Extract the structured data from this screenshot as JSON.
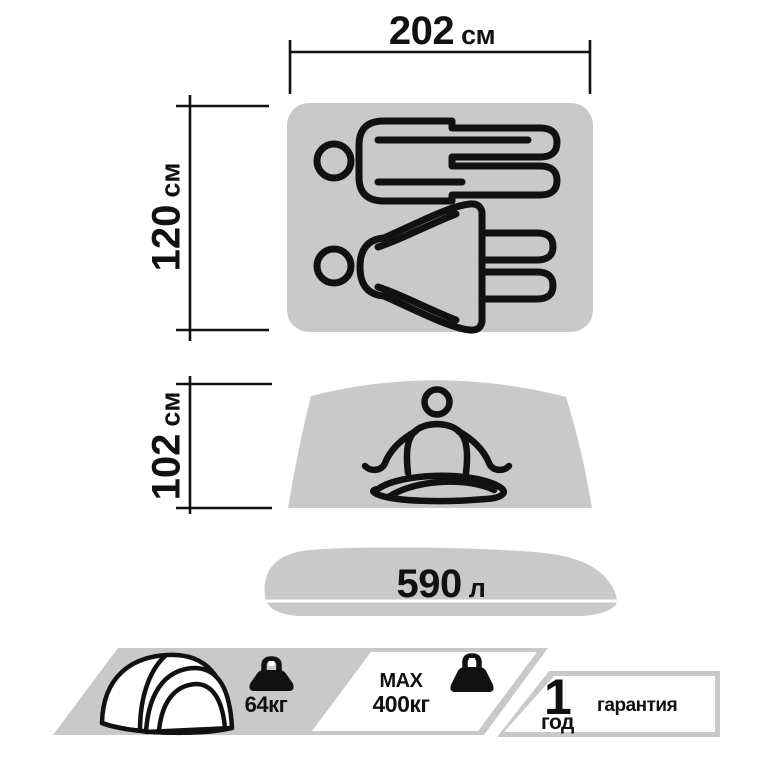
{
  "colors": {
    "shape": "#c9c9c9",
    "ink": "#111111",
    "bg": "#ffffff"
  },
  "floor_plan": {
    "width": {
      "value": "202",
      "unit": "см"
    },
    "depth": {
      "value": "120",
      "unit": "см"
    }
  },
  "cross_section": {
    "height": {
      "value": "102",
      "unit": "см"
    }
  },
  "volume": {
    "value": "590",
    "unit": "л"
  },
  "banner": {
    "packed_weight": {
      "label": "64кг"
    },
    "max_load": {
      "line1": "MAX",
      "line2": "400кг"
    },
    "warranty": {
      "number": "1",
      "unit": "год",
      "label": "гарантия"
    }
  },
  "icons": {
    "man_lying": "man-lying-icon",
    "woman_lying": "woman-lying-icon",
    "meditating_person": "meditating-person-icon",
    "tent": "tent-icon",
    "weight": "weight-icon"
  }
}
